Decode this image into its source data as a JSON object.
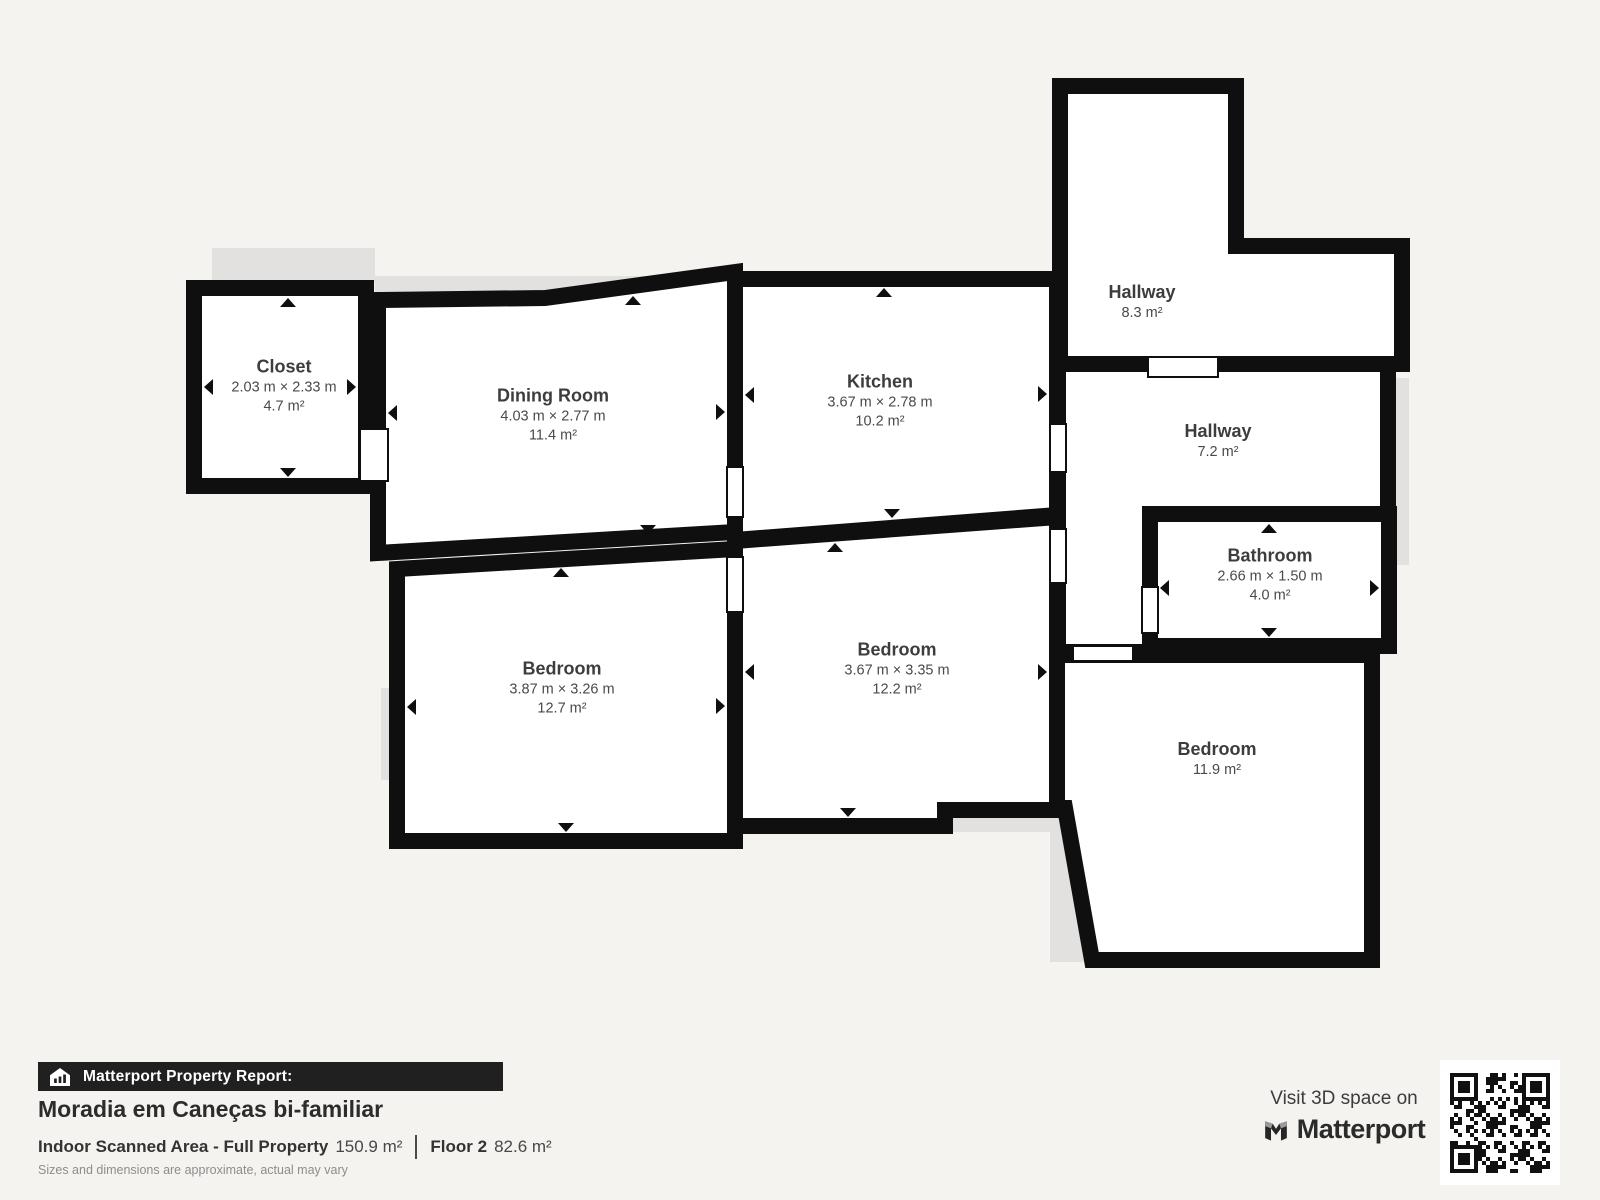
{
  "plan": {
    "rooms": [
      {
        "id": "closet",
        "name": "Closet",
        "dims": "2.03 m × 2.33 m",
        "area": "4.7 m²"
      },
      {
        "id": "dining-room",
        "name": "Dining Room",
        "dims": "4.03 m × 2.77 m",
        "area": "11.4 m²"
      },
      {
        "id": "kitchen",
        "name": "Kitchen",
        "dims": "3.67 m × 2.78 m",
        "area": "10.2 m²"
      },
      {
        "id": "hallway-upper",
        "name": "Hallway",
        "area": "8.3 m²"
      },
      {
        "id": "hallway-lower",
        "name": "Hallway",
        "area": "7.2 m²"
      },
      {
        "id": "bathroom",
        "name": "Bathroom",
        "dims": "2.66 m × 1.50 m",
        "area": "4.0 m²"
      },
      {
        "id": "bedroom-left",
        "name": "Bedroom",
        "dims": "3.87 m × 3.26 m",
        "area": "12.7 m²"
      },
      {
        "id": "bedroom-middle",
        "name": "Bedroom",
        "dims": "3.67 m × 3.35 m",
        "area": "12.2 m²"
      },
      {
        "id": "bedroom-right",
        "name": "Bedroom",
        "area": "11.9 m²"
      }
    ]
  },
  "footer": {
    "report_label": "Matterport Property Report:",
    "property_title": "Moradia em Caneças bi-familiar",
    "scanned_area_label": "Indoor Scanned Area - Full Property",
    "scanned_area_value": "150.9 m²",
    "floor_label": "Floor 2",
    "floor_value": "82.6 m²",
    "disclaimer": "Sizes and dimensions are approximate, actual may vary"
  },
  "branding": {
    "visit_text": "Visit 3D space on",
    "brand_name": "Matterport"
  },
  "colors": {
    "background": "#f4f3f0",
    "wall": "#0f0f0f",
    "room_fill": "#ffffff",
    "shadow": "#e3e1df",
    "bar_background": "#202020",
    "text_dark": "#3d3d3d"
  }
}
